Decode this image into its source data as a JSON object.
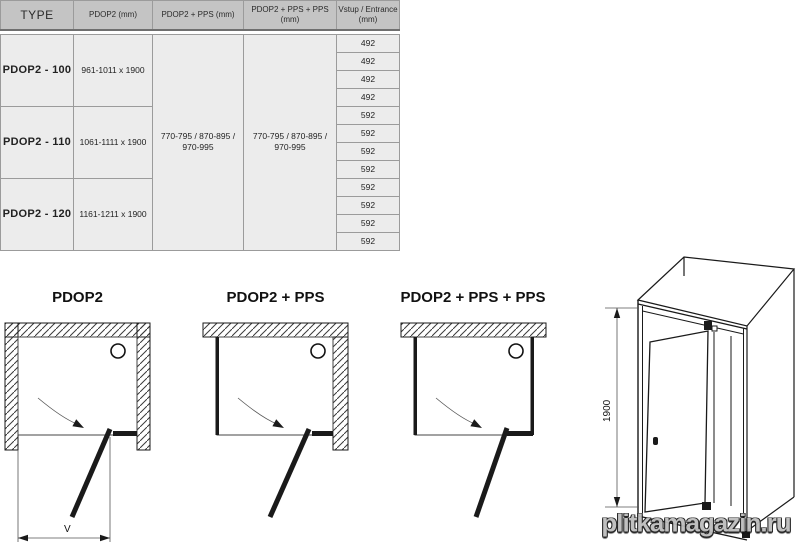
{
  "table": {
    "headers": {
      "type": "TYPE",
      "pdop2": "PDOP2 (mm)",
      "pdop2_pps": "PDOP2 + PPS (mm)",
      "pdop2_pps_pps": "PDOP2 + PPS + PPS (mm)",
      "entrance_line1": "Vstup / Entrance",
      "entrance_line2": "(mm)"
    },
    "groups": [
      {
        "type": "PDOP2 - 100",
        "size": "961-1011 x 1900",
        "entrances": [
          "492",
          "492",
          "492",
          "492"
        ]
      },
      {
        "type": "PDOP2 - 110",
        "size": "1061-1111 x 1900",
        "entrances": [
          "592",
          "592",
          "592",
          "592"
        ]
      },
      {
        "type": "PDOP2 - 120",
        "size": "1161-1211 x 1900",
        "entrances": [
          "592",
          "592",
          "592",
          "592"
        ]
      }
    ],
    "pps_line1": "770-795 / 870-895 /",
    "pps_line2": "970-995",
    "pps_pps_line1": "770-795 / 870-895 /",
    "pps_pps_line2": "970-995"
  },
  "diagrams": {
    "d1_title": "PDOP2",
    "d2_title": "PDOP2 + PPS",
    "d3_title": "PDOP2 + PPS + PPS",
    "width_dim_label": "V",
    "height_dim_label": "1900"
  },
  "watermark": "plitkamagazin.ru",
  "colors": {
    "header_bg": "#c4c4c4",
    "body_bg": "#ececec",
    "border": "#9b9b9b",
    "line": "#1a1a1a",
    "watermark": "#bdbdbd"
  }
}
